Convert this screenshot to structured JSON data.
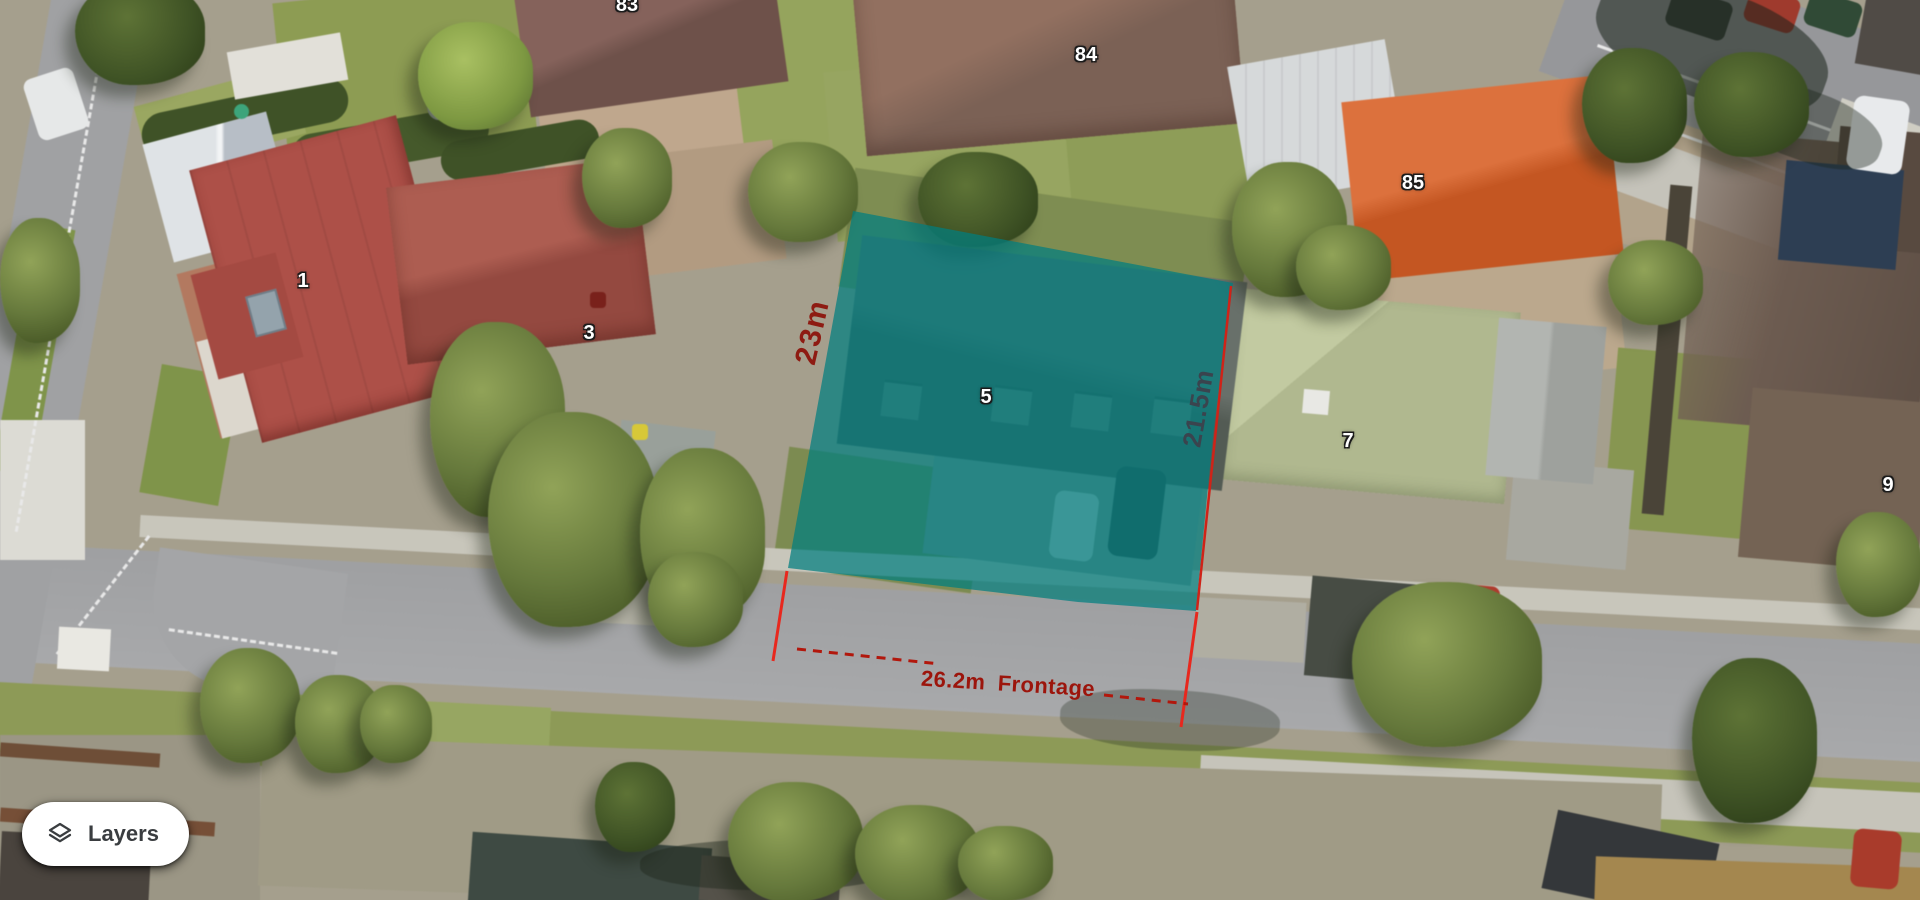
{
  "map_overlay": {
    "dimension_left": "23m",
    "dimension_right": "21.5m",
    "dimension_frontage": "26.2m Frontage"
  },
  "house_numbers": [
    {
      "label": "83",
      "x": 627,
      "y": -6
    },
    {
      "label": "84",
      "x": 1086,
      "y": 44
    },
    {
      "label": "85",
      "x": 1413,
      "y": 172
    },
    {
      "label": "1",
      "x": 303,
      "y": 270
    },
    {
      "label": "3",
      "x": 589,
      "y": 322
    },
    {
      "label": "5",
      "x": 986,
      "y": 386
    },
    {
      "label": "7",
      "x": 1348,
      "y": 430
    },
    {
      "label": "9",
      "x": 1888,
      "y": 474
    }
  ],
  "controls": {
    "layers_label": "Layers"
  },
  "colors": {
    "parcel_fill": "rgba(0,126,128,0.72)",
    "parcel_edge": "#cf2318",
    "measure_tick": "#e8281e",
    "measure_dash": "#b2170c",
    "frontage_text": "#9c150c",
    "side_left_text": "#8e1b12",
    "side_right_text": "#3a444e"
  }
}
